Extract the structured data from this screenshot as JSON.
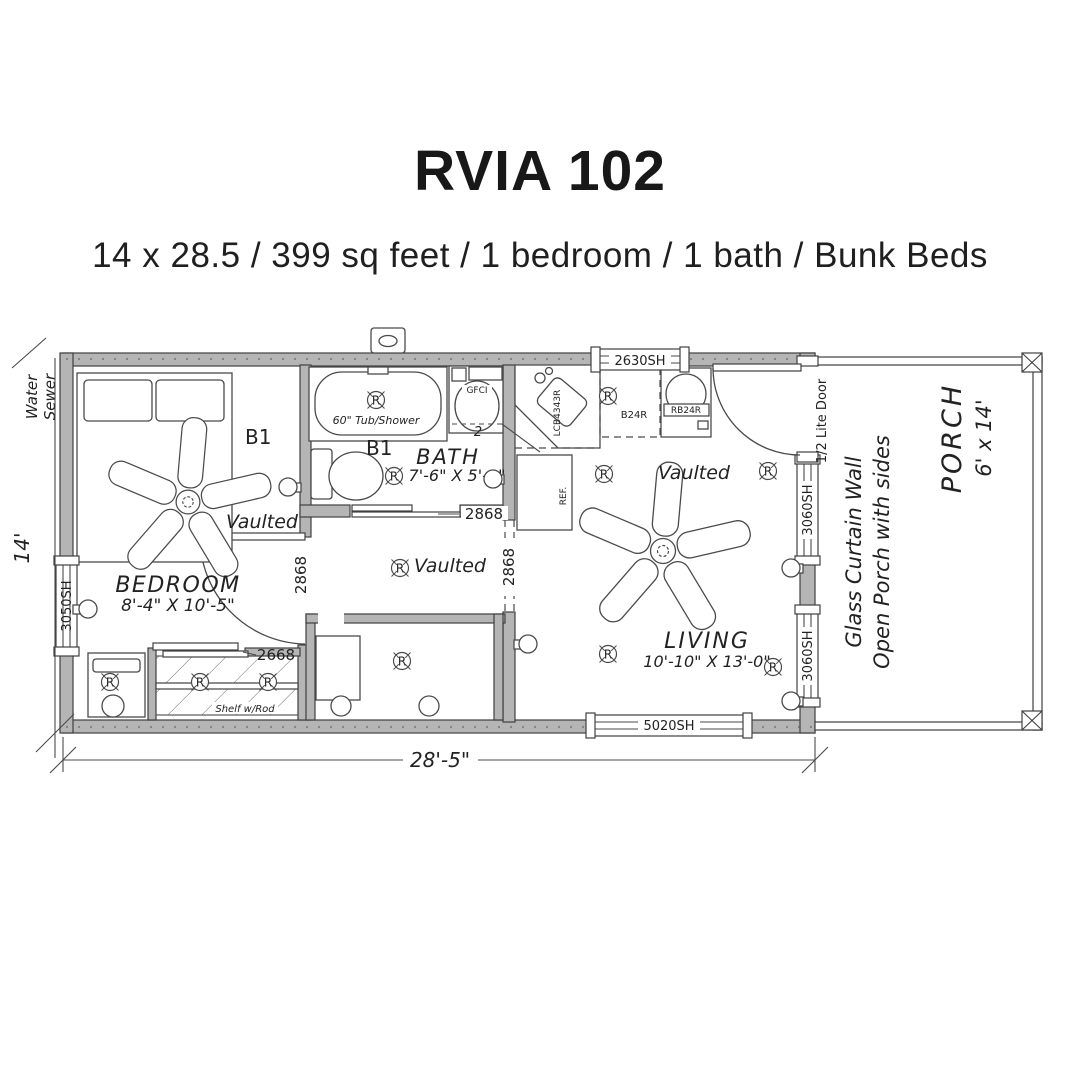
{
  "header": {
    "title": "RVIA 102",
    "subtitle": "14 x 28.5 / 399 sq feet / 1 bedroom / 1 bath / Bunk Beds"
  },
  "plan": {
    "dimensions": {
      "width": "28'-5\"",
      "height": "14'",
      "utilities_line1": "Water",
      "utilities_line2": "Sewer",
      "gap": "2"
    },
    "windows": {
      "left": "3050SH",
      "top": "2630SH",
      "bottom": "5020SH",
      "right_upper": "3060SH",
      "right_lower": "3060SH"
    },
    "doors": {
      "entry": "1/2 Lite Door",
      "bedroom": "2868",
      "bath": "2868",
      "hall_opening": "2868",
      "closet": "2668"
    },
    "rooms": {
      "bedroom": {
        "name": "BEDROOM",
        "size": "8'-4\" X 10'-5\"",
        "ceiling": "Vaulted",
        "bunk": "B1"
      },
      "bath": {
        "name": "BATH",
        "size": "7'-6\" X 5'-3\"",
        "bunk": "B1",
        "tub": "60\" Tub/Shower",
        "outlet": "GFCI"
      },
      "hall": {
        "ceiling": "Vaulted"
      },
      "living": {
        "name": "LIVING",
        "size": "10'-10\" X 13'-0\"",
        "ceiling": "Vaulted"
      },
      "porch": {
        "name": "PORCH",
        "size": "6' x 14'",
        "wall_line1": "Glass Curtain Wall",
        "wall_line2": "Open Porch with sides"
      }
    },
    "kitchen": {
      "corner_cabinet": "LCB4343R",
      "base_cabinet": "B24R",
      "range_base": "RB24R",
      "fridge": "REF."
    },
    "closet": {
      "label": "Shelf w/Rod"
    },
    "symbols": {
      "recessed_light": "R"
    }
  },
  "colors": {
    "line": "#3f3f3f",
    "wall_fill": "#b5b5b5",
    "text": "#1c1c1c"
  }
}
